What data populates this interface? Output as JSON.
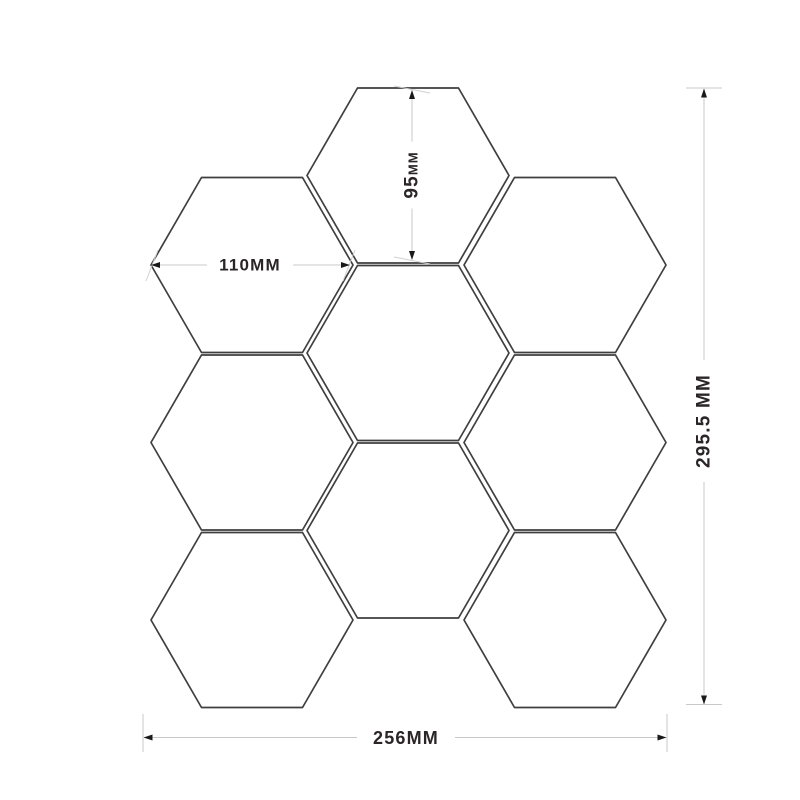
{
  "colors": {
    "background": "#ffffff",
    "hex_outline": "#3f3f3f",
    "dim_line": "#c9c9c9",
    "cap": "#c9c9c9",
    "tick": "#d2d2d2",
    "arrow": "#1a1a1a",
    "text": "#2b2527"
  },
  "hexagon_shape": {
    "radius_px": 101,
    "half_height_px": 87.5
  },
  "hexagons": [
    {
      "id": "top-center",
      "cx": 408,
      "cy": 175.5
    },
    {
      "id": "upper-left",
      "cx": 252,
      "cy": 265
    },
    {
      "id": "upper-right",
      "cx": 565,
      "cy": 265
    },
    {
      "id": "middle-center",
      "cx": 408,
      "cy": 353
    },
    {
      "id": "middle-left",
      "cx": 252,
      "cy": 442.5
    },
    {
      "id": "middle-right",
      "cx": 565,
      "cy": 442.5
    },
    {
      "id": "lower-center",
      "cx": 408,
      "cy": 530.5
    },
    {
      "id": "bottom-left",
      "cx": 252,
      "cy": 620
    },
    {
      "id": "bottom-right",
      "cx": 565,
      "cy": 620
    }
  ],
  "dimensions": {
    "hex_height": {
      "label": "95MM",
      "number": "95",
      "unit": "MM",
      "measures": "single-hexagon-height",
      "segments": [
        {
          "role": "line",
          "x1": 412,
          "y1": 91,
          "x2": 412,
          "y2": 259
        },
        {
          "role": "tick",
          "x1": 394,
          "y1": 86,
          "x2": 430,
          "y2": 93
        },
        {
          "role": "tick",
          "x1": 394,
          "y1": 257,
          "x2": 430,
          "y2": 264
        }
      ],
      "arrows": [
        {
          "x": 412,
          "y": 90,
          "dir": "up"
        },
        {
          "x": 412,
          "y": 260,
          "dir": "down"
        }
      ]
    },
    "hex_width": {
      "label": "110MM",
      "measures": "single-hexagon-width",
      "segments": [
        {
          "role": "line",
          "x1": 153,
          "y1": 265,
          "x2": 348,
          "y2": 265
        },
        {
          "role": "tick",
          "x1": 146,
          "y1": 281,
          "x2": 158,
          "y2": 250
        },
        {
          "role": "tick",
          "x1": 343,
          "y1": 281,
          "x2": 355,
          "y2": 250
        }
      ],
      "arrows": [
        {
          "x": 151,
          "y": 265,
          "dir": "left"
        },
        {
          "x": 350,
          "y": 265,
          "dir": "right"
        }
      ]
    },
    "sheet_height": {
      "label": "295.5 MM",
      "measures": "overall-sheet-height",
      "segments": [
        {
          "role": "line",
          "x1": 704,
          "y1": 89,
          "x2": 704,
          "y2": 704
        },
        {
          "role": "cap",
          "x1": 686,
          "y1": 88,
          "x2": 722,
          "y2": 88
        },
        {
          "role": "cap",
          "x1": 686,
          "y1": 704.5,
          "x2": 722,
          "y2": 704.5
        }
      ],
      "arrows": [
        {
          "x": 704,
          "y": 88.5,
          "dir": "up"
        },
        {
          "x": 704,
          "y": 704.5,
          "dir": "down"
        }
      ]
    },
    "sheet_width": {
      "label": "256MM",
      "measures": "overall-sheet-width",
      "segments": [
        {
          "role": "line",
          "x1": 144,
          "y1": 737.5,
          "x2": 666,
          "y2": 737.5
        },
        {
          "role": "cap",
          "x1": 143,
          "y1": 714,
          "x2": 143,
          "y2": 752
        },
        {
          "role": "cap",
          "x1": 667,
          "y1": 714,
          "x2": 667,
          "y2": 752
        }
      ],
      "arrows": [
        {
          "x": 143.5,
          "y": 737.5,
          "dir": "left"
        },
        {
          "x": 666.5,
          "y": 737.5,
          "dir": "right"
        }
      ]
    }
  }
}
